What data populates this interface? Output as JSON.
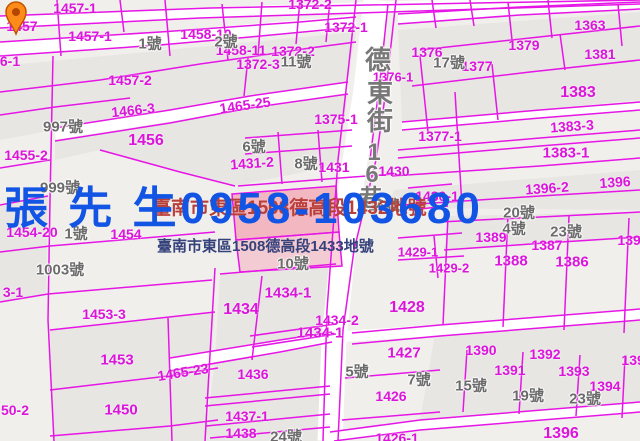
{
  "map": {
    "street_name": "德東街16巷",
    "contact_overlay": "張 先 生0958-103680",
    "address_label_1": "臺南市東區1508德高段1432地號",
    "address_label_2": "臺南市東區1508德高段1433地號",
    "colors": {
      "boundary_magenta": "#E616E6",
      "parcel_text_magenta": "#DC14DC",
      "house_text_grey": "#6B6B6B",
      "overlay_blue": "#1254E4",
      "address1_red": "#B9403A",
      "address2_navy": "#35417B",
      "highlight_pink": "#F2889C",
      "pin_orange": "#FF8C1A"
    },
    "street_chars": [
      {
        "t": "德",
        "x": 378,
        "y": 60,
        "s": 26
      },
      {
        "t": "東",
        "x": 380,
        "y": 93,
        "s": 26
      },
      {
        "t": "街",
        "x": 380,
        "y": 121,
        "s": 26
      },
      {
        "t": "1",
        "x": 374,
        "y": 153,
        "s": 24
      },
      {
        "t": "6",
        "x": 372,
        "y": 175,
        "s": 24
      },
      {
        "t": "巷",
        "x": 371,
        "y": 199,
        "s": 24
      }
    ],
    "parcel_labels": [
      {
        "t": "1457-1",
        "x": 75,
        "y": 8
      },
      {
        "t": "1372-2",
        "x": 310,
        "y": 4
      },
      {
        "t": "1457",
        "x": 22,
        "y": 26
      },
      {
        "t": "1457-1",
        "x": 90,
        "y": 36
      },
      {
        "t": "1458-10",
        "x": 206,
        "y": 34
      },
      {
        "t": "1372-1",
        "x": 346,
        "y": 27
      },
      {
        "t": "1458-11",
        "x": 241,
        "y": 50
      },
      {
        "t": "1372-2",
        "x": 293,
        "y": 51
      },
      {
        "t": "1372-3",
        "x": 258,
        "y": 64
      },
      {
        "t": "1363",
        "x": 590,
        "y": 25
      },
      {
        "t": "1379",
        "x": 524,
        "y": 45
      },
      {
        "t": "1381",
        "x": 600,
        "y": 54
      },
      {
        "t": "1376",
        "x": 427,
        "y": 52
      },
      {
        "t": "1377",
        "x": 477,
        "y": 66
      },
      {
        "t": "1376-1",
        "x": 393,
        "y": 77,
        "s": 13
      },
      {
        "t": "1457-2",
        "x": 130,
        "y": 80
      },
      {
        "t": "6-1",
        "x": 10,
        "y": 61
      },
      {
        "t": "1383",
        "x": 578,
        "y": 93,
        "s": 16
      },
      {
        "t": "1465-25",
        "x": 245,
        "y": 105,
        "r": -8
      },
      {
        "t": "1466-3",
        "x": 133,
        "y": 110,
        "r": -6
      },
      {
        "t": "1455-2",
        "x": 26,
        "y": 155
      },
      {
        "t": "1456",
        "x": 146,
        "y": 141,
        "s": 16
      },
      {
        "t": "1375-1",
        "x": 336,
        "y": 119
      },
      {
        "t": "1377-1",
        "x": 440,
        "y": 136
      },
      {
        "t": "1383-3",
        "x": 572,
        "y": 126,
        "r": -4
      },
      {
        "t": "1383-1",
        "x": 566,
        "y": 153,
        "s": 15
      },
      {
        "t": "1431-2",
        "x": 252,
        "y": 163,
        "r": -4
      },
      {
        "t": "1431",
        "x": 334,
        "y": 167
      },
      {
        "t": "1430",
        "x": 394,
        "y": 171
      },
      {
        "t": "1430-1",
        "x": 437,
        "y": 196
      },
      {
        "t": "1396",
        "x": 615,
        "y": 182,
        "r": -4
      },
      {
        "t": "1396-2",
        "x": 547,
        "y": 188,
        "r": -4
      },
      {
        "t": "1454-20",
        "x": 32,
        "y": 232
      },
      {
        "t": "1454",
        "x": 126,
        "y": 234
      },
      {
        "t": "1429-1",
        "x": 418,
        "y": 252,
        "s": 13
      },
      {
        "t": "1429-2",
        "x": 449,
        "y": 268,
        "s": 13
      },
      {
        "t": "1389",
        "x": 491,
        "y": 237
      },
      {
        "t": "1387",
        "x": 547,
        "y": 245
      },
      {
        "t": "1388",
        "x": 511,
        "y": 261,
        "s": 15
      },
      {
        "t": "1386",
        "x": 572,
        "y": 262,
        "s": 15
      },
      {
        "t": "1392",
        "x": 633,
        "y": 240
      },
      {
        "t": "1434",
        "x": 241,
        "y": 310,
        "s": 16
      },
      {
        "t": "1434-1",
        "x": 288,
        "y": 293,
        "s": 15
      },
      {
        "t": "1434-2",
        "x": 337,
        "y": 320
      },
      {
        "t": "1434-1",
        "x": 320,
        "y": 333,
        "s": 15
      },
      {
        "t": "1428",
        "x": 407,
        "y": 308,
        "s": 16
      },
      {
        "t": "1427",
        "x": 404,
        "y": 353,
        "s": 15
      },
      {
        "t": "1453-3",
        "x": 104,
        "y": 314
      },
      {
        "t": "3-1",
        "x": 13,
        "y": 292
      },
      {
        "t": "1453",
        "x": 117,
        "y": 360,
        "s": 15
      },
      {
        "t": "1465-23",
        "x": 183,
        "y": 372,
        "r": -9
      },
      {
        "t": "1450",
        "x": 121,
        "y": 410,
        "s": 15
      },
      {
        "t": "50-2",
        "x": 15,
        "y": 410
      },
      {
        "t": "1436",
        "x": 253,
        "y": 374
      },
      {
        "t": "1437-1",
        "x": 247,
        "y": 416
      },
      {
        "t": "1438",
        "x": 241,
        "y": 433
      },
      {
        "t": "1426",
        "x": 391,
        "y": 396
      },
      {
        "t": "1426-1",
        "x": 397,
        "y": 438
      },
      {
        "t": "1390",
        "x": 481,
        "y": 350
      },
      {
        "t": "1392",
        "x": 545,
        "y": 354
      },
      {
        "t": "1391",
        "x": 510,
        "y": 370
      },
      {
        "t": "1393",
        "x": 574,
        "y": 371
      },
      {
        "t": "1394",
        "x": 605,
        "y": 386
      },
      {
        "t": "1395",
        "x": 637,
        "y": 360
      },
      {
        "t": "1396",
        "x": 561,
        "y": 434,
        "s": 16
      }
    ],
    "house_labels": [
      {
        "t": "1號",
        "x": 150,
        "y": 44
      },
      {
        "t": "2號",
        "x": 226,
        "y": 42
      },
      {
        "t": "11號",
        "x": 296,
        "y": 62
      },
      {
        "t": "17號",
        "x": 449,
        "y": 63
      },
      {
        "t": "997號",
        "x": 63,
        "y": 127
      },
      {
        "t": "999號",
        "x": 60,
        "y": 188
      },
      {
        "t": "6號",
        "x": 254,
        "y": 147
      },
      {
        "t": "8號",
        "x": 306,
        "y": 164
      },
      {
        "t": "16號",
        "x": 384,
        "y": 206
      },
      {
        "t": "20號",
        "x": 519,
        "y": 213
      },
      {
        "t": "1號",
        "x": 76,
        "y": 234
      },
      {
        "t": "1003號",
        "x": 60,
        "y": 270
      },
      {
        "t": "10號",
        "x": 293,
        "y": 264
      },
      {
        "t": "4號",
        "x": 514,
        "y": 229
      },
      {
        "t": "23號",
        "x": 566,
        "y": 232
      },
      {
        "t": "5號",
        "x": 357,
        "y": 372
      },
      {
        "t": "7號",
        "x": 419,
        "y": 380
      },
      {
        "t": "15號",
        "x": 471,
        "y": 386
      },
      {
        "t": "19號",
        "x": 528,
        "y": 396
      },
      {
        "t": "23號",
        "x": 585,
        "y": 399
      },
      {
        "t": "24號",
        "x": 286,
        "y": 437
      }
    ]
  }
}
